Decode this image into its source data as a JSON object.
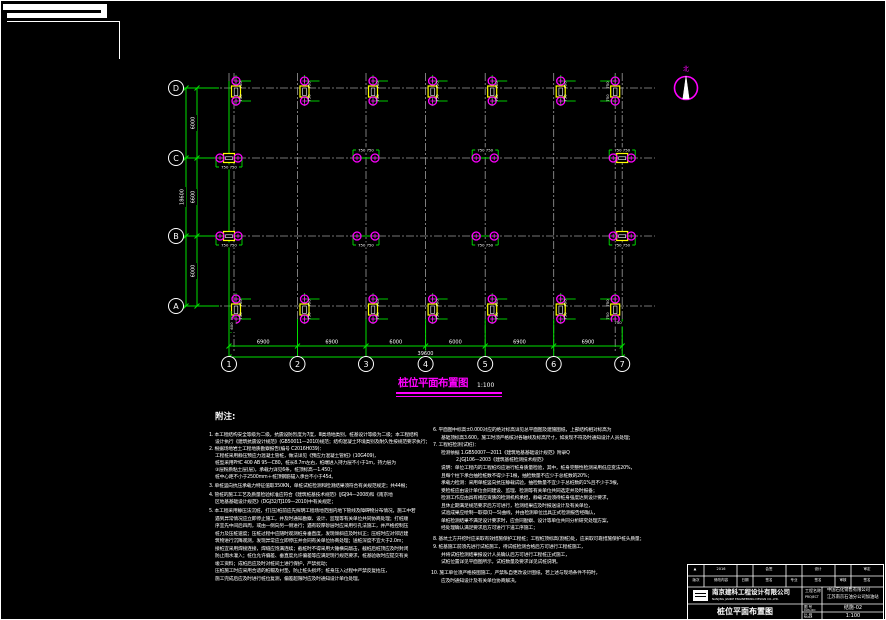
{
  "colors": {
    "green": "#00e000",
    "magenta": "#ff00ff",
    "yellow": "#ffff00",
    "gray": "#9c9c9c",
    "white": "#ffffff",
    "bg": "#000000"
  },
  "north": {
    "label": "北"
  },
  "drawing_title": {
    "text": "桩位平面布置图",
    "scale": "1:100"
  },
  "notes": {
    "header": "附注:",
    "left": [
      {
        "x": 208,
        "y": 433,
        "t": "1. 本工程结构安全等级为二级，抗震设防烈度为7度，Ⅲ类场地类别，桩基设计等级为二级；本工程结构"
      },
      {
        "x": 214,
        "y": 440,
        "t": "设计执行《建筑抗震设计规范》(GB50011—2010)规范；结构混凝土环境类别及耐久性按规范要求执行；"
      },
      {
        "x": 208,
        "y": 447,
        "t": "2. 根据场地岩土工程地质勘察报告(编号 C2016H039)："
      },
      {
        "x": 214,
        "y": 454,
        "t": "工程桩采用静压预应力混凝土管桩，做法详见《预应力混凝土管桩》(10G409)，"
      },
      {
        "x": 214,
        "y": 461,
        "t": "桩型采用PHC 400 AB 95—C80，桩长8.7m左右，桩端进入持力层不小于1m，持力层为"
      },
      {
        "x": 214,
        "y": 468,
        "t": "③层粉质粘土层(层)，承载力详见6条，桩顶标高—1.450；"
      },
      {
        "x": 214,
        "y": 475,
        "t": "桩中心距不小于2500mm＋桩顶钢筋锚入承台不小于45d。"
      },
      {
        "x": 208,
        "y": 484,
        "t": "3. 单桩竖向抗压承载力特征值取350KN，单桩试桩检测和检测结果须符合有关规范规定；共44根；"
      },
      {
        "x": 208,
        "y": 493,
        "t": "4. 管桩的施工工艺及质量检验标准应符合《建筑桩基技术规范》(JGJ94—2008)和《南京地"
      },
      {
        "x": 214,
        "y": 500,
        "t": "区地基基础设计规范》(DGJ32/TJ109—2010)中有关规定；"
      },
      {
        "x": 208,
        "y": 509,
        "t": "5. 本工程采用静压法沉桩，打(压)桩前应先探明工程场地范围内地下管线及障碍物分布情况，施工中若"
      },
      {
        "x": 214,
        "y": 516.5,
        "t": "遇到异常情况应立即停止施工，并及时通知勘察、设计、监理等有关单位共同协商处理；打桩顺"
      },
      {
        "x": 214,
        "y": 524,
        "t": "序宜先中间后四周，或由一侧向另一侧进行；遇有较厚砂层时应采用引孔法施工，并严格控制压"
      },
      {
        "x": 214,
        "y": 531.5,
        "t": "桩力及压桩速度；压桩过程中应随时观测桩身垂直度，发现倾斜应及时纠正；压桩时应对邻近建"
      },
      {
        "x": 214,
        "y": 539,
        "t": "筑物进行沉降观测，发现异常应立即停压并会同有关单位协商处理；送桩深度不宜大于2.0m；"
      },
      {
        "x": 214,
        "y": 546.5,
        "t": "接桩宜采用焊接连接，焊缝应饱满连续；截桩时不得采用大锤横向敲击，截桩后桩顶应及时封闭"
      },
      {
        "x": 214,
        "y": 554,
        "t": "防止雨水灌入；桩位允许偏差、垂直度允许偏差等应满足现行规范要求，桩基验收时应提交有关"
      },
      {
        "x": 214,
        "y": 561.5,
        "t": "竣工资料；成桩后应及时对桩间土进行保护，严禁扰动；"
      },
      {
        "x": 214,
        "y": 569,
        "t": "压桩施工时应采用合适的桩帽及衬垫，防止桩头损坏；桩身压入过程中严禁反复抬压，"
      },
      {
        "x": 214,
        "y": 576.5,
        "t": "施工完成后应及时进行桩位复测，偏差超限时应及时通知设计单位处理。"
      }
    ],
    "right": [
      {
        "x": 432,
        "y": 428,
        "t": "6. 平面图中标高±0.000对应的绝对标高详见总平面图及建施图纸，上部结构相对标高为"
      },
      {
        "x": 440,
        "y": 435.5,
        "t": "基础顶标高3.600，施工时须严格核对各轴线及标高尺寸，如发现不符及时通知设计人员处理；"
      },
      {
        "x": 432,
        "y": 443,
        "t": "7. 工程桩检测(试桩)："
      },
      {
        "x": 440,
        "y": 450.5,
        "t": "检测依据 1.GB50007—2011《建筑地基基础设计规范》附录Q"
      },
      {
        "x": 455,
        "y": 458,
        "t": "2.JGJ106—2003《建筑基桩检测技术规范》"
      },
      {
        "x": 440,
        "y": 466,
        "t": "说明：单位工程内的工程桩均应进行桩身质量检验，其中，桩身完整性检测采用低应变法20%，"
      },
      {
        "x": 440,
        "y": 473.5,
        "t": "且每个柱下承台抽检桩数不得少于1根，抽检数量不应少于总桩数的20%；"
      },
      {
        "x": 440,
        "y": 481,
        "t": "承载力检测：采用单桩竖向抗压静载试验，抽检数量不宜少于总桩数的1%且不少于3根，"
      },
      {
        "x": 440,
        "y": 488.5,
        "t": "受检桩应由设计单位会同建设、监理、检测等有关单位共同选定并及时报备；"
      },
      {
        "x": 440,
        "y": 496,
        "t": "检测工作应由具有相应资质的检测机构承担，静载试验须待桩身强度达到设计要求，"
      },
      {
        "x": 440,
        "y": 503.5,
        "t": "且休止期满足规范要求后方可进行，检测结果应及时报送设计及有关单位，"
      },
      {
        "x": 440,
        "y": 511,
        "t": "试验成果应绘制—取得(Q—S)曲线，并由检测单位出具正式检测报告经确认，"
      },
      {
        "x": 440,
        "y": 518.5,
        "t": "单桩检测结果不满足设计要求时，应会同勘察、设计等单位共同分析研究处理方案，"
      },
      {
        "x": 440,
        "y": 526,
        "t": "经处理确认满足要求后方可进行下道工序施工；"
      },
      {
        "x": 432,
        "y": 537,
        "t": "8. 基坑土方开挖时应采取有效措施保护工程桩；工程桩顶标高(割桩)处，应采取可靠措施保护桩头质量；"
      },
      {
        "x": 432,
        "y": 545,
        "t": "9. 桩基施工前须先进行试桩施工，待试桩检测合格后方可进行工程桩施工，"
      },
      {
        "x": 440,
        "y": 552.5,
        "t": "并将试桩检测结果报设计人员确认后方可进行工程桩正式施工，"
      },
      {
        "x": 440,
        "y": 560,
        "t": "试桩位置详见平面图所示，试桩数量及要求详见试桩说明。"
      },
      {
        "x": 430,
        "y": 571,
        "t": "10. 施工单位须严格按图施工，严禁私自更改设计图纸，若上述与现场条件不符时，"
      },
      {
        "x": 440,
        "y": 578.5,
        "t": "应及时通知设计及有关单位协商解决。"
      }
    ]
  },
  "plan": {
    "cols": [
      {
        "label": "1",
        "x": 228
      },
      {
        "label": "2",
        "x": 296.5
      },
      {
        "label": "3",
        "x": 365
      },
      {
        "label": "4",
        "x": 424.6
      },
      {
        "label": "5",
        "x": 484.2
      },
      {
        "label": "6",
        "x": 552.7
      },
      {
        "label": "7",
        "x": 621.2
      }
    ],
    "rows": [
      {
        "label": "D",
        "y": 87
      },
      {
        "label": "C",
        "y": 157
      },
      {
        "label": "B",
        "y": 235
      },
      {
        "label": "A",
        "y": 305
      }
    ],
    "bubble_x": 175,
    "bubble_y": 363,
    "grid_top": 72,
    "grid_bottom": 350,
    "grid_left": 195,
    "grid_right": 654,
    "bottom_dims": {
      "segments": [
        "6900",
        "6900",
        "6000",
        "6000",
        "6900",
        "6900"
      ],
      "total": "39600"
    },
    "left_dims": {
      "segments": [
        "6000",
        "6600",
        "6000"
      ],
      "total": "18600"
    },
    "pile_dim": "750",
    "pair_dim": "750 750",
    "extra_labels": [
      {
        "x": 232,
        "y": 325,
        "t": "600",
        "rot": -90
      },
      {
        "x": 617,
        "y": 323,
        "t": "750",
        "rot": 0
      }
    ]
  },
  "titleblock": {
    "row1": [
      {
        "x": 693,
        "y": 570,
        "t": "▲"
      },
      {
        "x": 719,
        "y": 570,
        "t": "2016"
      },
      {
        "x": 767,
        "y": 570,
        "t": "会签"
      },
      {
        "x": 816,
        "y": 570,
        "t": "设计"
      },
      {
        "x": 865,
        "y": 570,
        "t": "审定"
      }
    ],
    "row2": [
      {
        "x": 694,
        "y": 581,
        "t": "版次"
      },
      {
        "x": 719,
        "y": 581,
        "t": "修改内容"
      },
      {
        "x": 743,
        "y": 581,
        "t": "日期"
      },
      {
        "x": 767,
        "y": 581,
        "t": "签名"
      },
      {
        "x": 792,
        "y": 581,
        "t": "专业"
      },
      {
        "x": 816,
        "y": 581,
        "t": "签名"
      },
      {
        "x": 841,
        "y": 581,
        "t": "审核"
      },
      {
        "x": 865,
        "y": 581,
        "t": "签名"
      }
    ],
    "company_cn": "南京建科工程设计有限公司",
    "company_en": "NANJING JIANKE ENGINEERING DESIGN CO.,LTD.",
    "project_label_cn": "工程名称",
    "project_label_en": "PROJECT",
    "project_line1": "中国石化销售有限公司",
    "project_line2": "江苏南京石油分公司加油站",
    "drawing_title": "桩位平面布置图",
    "no_label_cn": "图 号",
    "no_label_en": "DWG.NO",
    "no_value": "结施-02",
    "scale_label_cn": "比 例",
    "scale_label_en": "SCALE",
    "scale_value": "1:100"
  }
}
